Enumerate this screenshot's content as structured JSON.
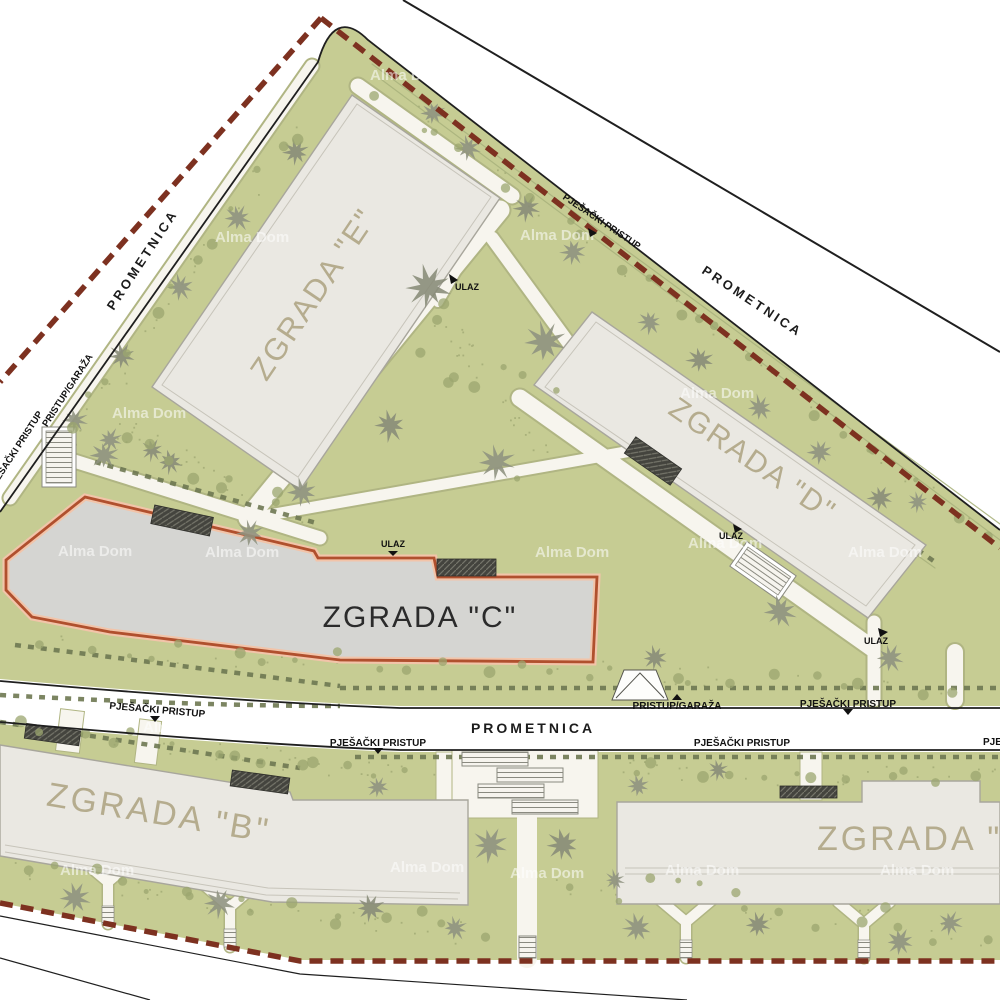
{
  "buildings": {
    "e": {
      "label": "ZGRADA \"E\""
    },
    "d": {
      "label": "ZGRADA \"D\""
    },
    "c": {
      "label": "ZGRADA \"C\""
    },
    "b": {
      "label": "ZGRADA \"B\""
    },
    "a": {
      "label": "ZGRADA \"A\""
    }
  },
  "roads": {
    "prometnica": "PROMETNICA"
  },
  "labels": {
    "pjesacki_pristup": "PJEŠAČKI PRISTUP",
    "pristup_garaza": "PRISTUP/GARAŽA",
    "ulaz": "ULAZ"
  },
  "watermark": {
    "text": "Alma Dom"
  },
  "colors": {
    "boundary_dash": "#7d3120",
    "c_outline": "#b0502e",
    "c_halo": "#f2c4a9",
    "green": "#c6cc93",
    "building_fill": "#eae8e2",
    "c_fill": "#d5d5d2",
    "beige_label": "#b5ac8e",
    "road_line": "#1f1f1f",
    "tree": "#8e9280",
    "hedge": "#6e7852"
  }
}
